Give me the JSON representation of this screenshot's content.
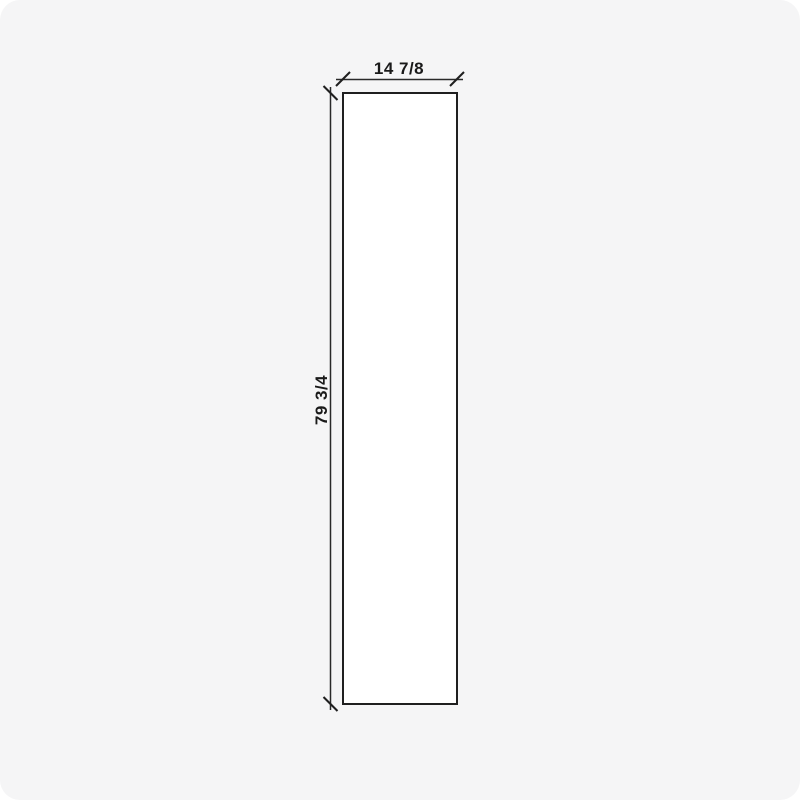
{
  "drawing": {
    "type": "panel-dimension-drawing",
    "width_label": "14 7/8",
    "height_label": "79 3/4"
  },
  "colors": {
    "background": "#f5f5f6",
    "panel_fill": "#ffffff",
    "line": "#1f1f1f",
    "dimension_line": "#2a2a2a",
    "text": "#1a1a1a"
  }
}
